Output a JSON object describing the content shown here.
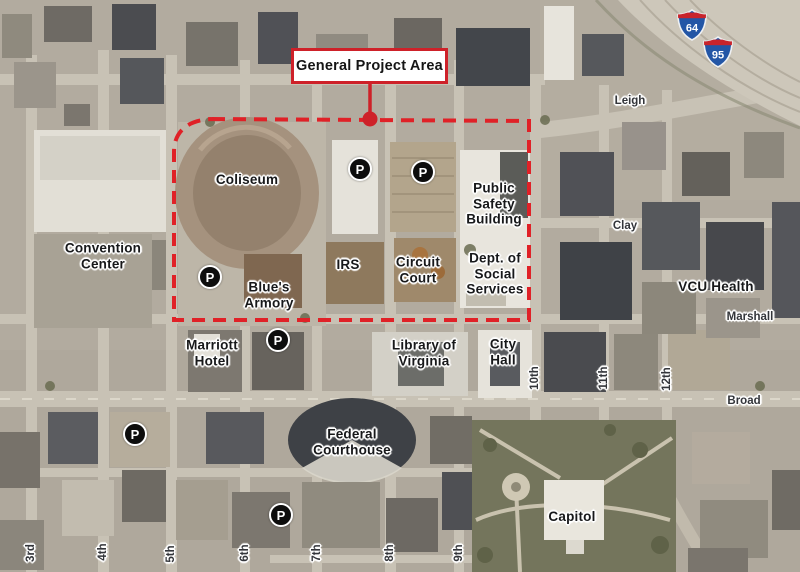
{
  "callout": {
    "text": "General Project Area"
  },
  "parking": {
    "symbol": "P"
  },
  "shields": [
    {
      "number": "64"
    },
    {
      "number": "95"
    }
  ],
  "building_labels": [
    {
      "text": "Coliseum"
    },
    {
      "text": "Convention\nCenter"
    },
    {
      "text": "Blue's\nArmory"
    },
    {
      "text": "Marriott\nHotel"
    },
    {
      "text": "IRS"
    },
    {
      "text": "Circuit\nCourt"
    },
    {
      "text": "Public\nSafety\nBuilding"
    },
    {
      "text": "Dept. of\nSocial\nServices"
    },
    {
      "text": "Library of\nVirginia"
    },
    {
      "text": "City\nHall"
    },
    {
      "text": "Federal\nCourthouse"
    },
    {
      "text": "Capitol"
    },
    {
      "text": "VCU Health"
    }
  ],
  "street_labels_h": [
    {
      "text": "Leigh"
    },
    {
      "text": "Clay"
    },
    {
      "text": "Marshall"
    },
    {
      "text": "Broad"
    }
  ],
  "street_labels_v": [
    {
      "text": "3rd"
    },
    {
      "text": "4th"
    },
    {
      "text": "5th"
    },
    {
      "text": "6th"
    },
    {
      "text": "7th"
    },
    {
      "text": "8th"
    },
    {
      "text": "9th"
    },
    {
      "text": "10th"
    },
    {
      "text": "11th"
    },
    {
      "text": "12th"
    }
  ],
  "colors": {
    "boundary_red": "#e02127",
    "callout_border_red": "#ce2129",
    "interstate_blue": "#2356a6",
    "interstate_red": "#c8242c"
  }
}
